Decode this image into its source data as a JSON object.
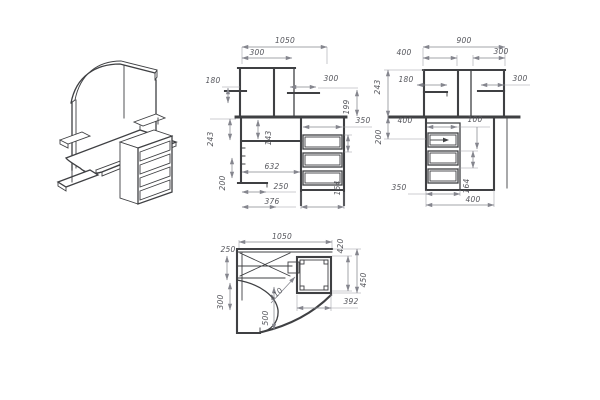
{
  "meta": {
    "drawing_type": "corner-computer-desk-technical-drawing",
    "background": "#ffffff",
    "line_color": "#3f4043",
    "dimension_color": "#85868e",
    "text_color": "#55565c"
  },
  "front_view": {
    "label": "front-view",
    "dims": {
      "overall_width": "1050",
      "hutch_left_width": "300",
      "left_shelf": "180",
      "right_shelf": "300",
      "shelf_to_top": "199",
      "under_top": "243",
      "inner_clear": "143",
      "inner_width": "632",
      "leg_zone": "200",
      "foot_width": "250",
      "left_section": "376",
      "drawer_opening": "350",
      "drawer_pitch": "164"
    }
  },
  "side_view": {
    "label": "side-view",
    "dims": {
      "overall_depth": "900",
      "back_section": "400",
      "front_section": "300",
      "hutch_height": "243",
      "shelf_inset": "180",
      "shelf_depth": "300",
      "under_top": "200",
      "pedestal_inner": "400",
      "gap": "100",
      "drawer_pitch": "164",
      "opening_width": "350",
      "pedestal_width": "400"
    }
  },
  "plan_view": {
    "label": "plan-view",
    "dims": {
      "overall_width": "1050",
      "wall_shelf_depth": "250",
      "left_wing": "300",
      "curve_offset": "500",
      "diagonal": "410",
      "right_opening": "420",
      "right_depth": "450",
      "pedestal_width": "392"
    }
  },
  "isometric_view": {
    "label": "isometric-view"
  }
}
